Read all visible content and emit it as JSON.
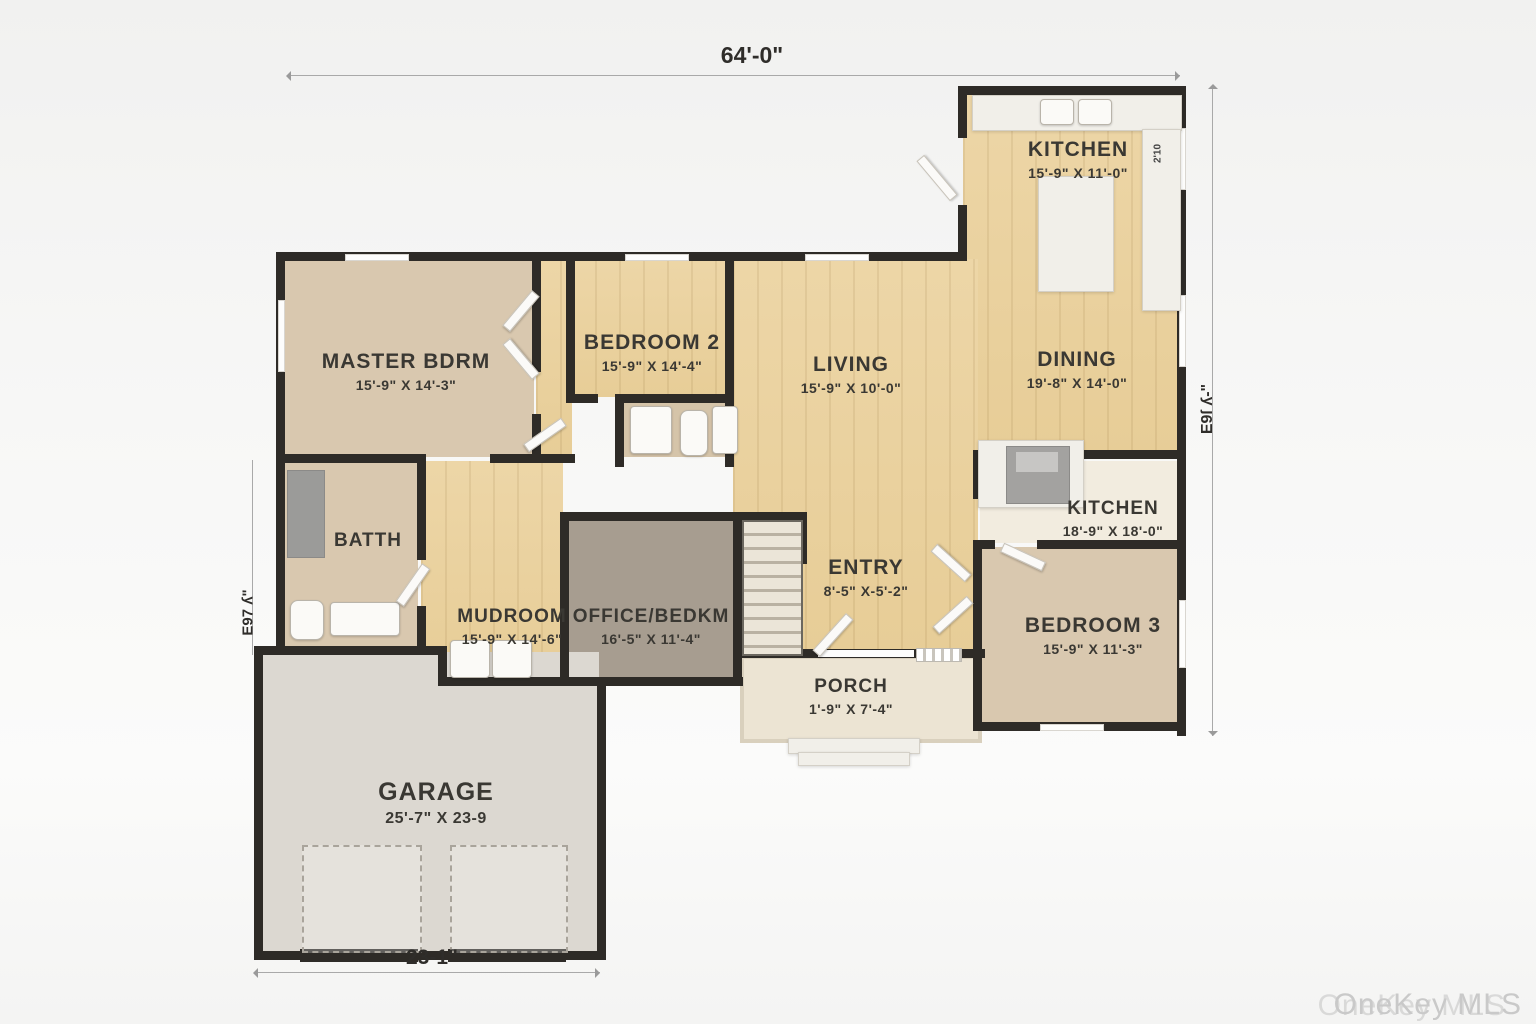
{
  "watermark": "OneKey MLS",
  "plan": {
    "dimensions": {
      "top": "64'-0\"",
      "bottom": "23-1\"",
      "right_vertical": "E9ſ ʎ-\"",
      "left_vertical": "E97 ʎ\"",
      "kitchen_counter": "2'10"
    },
    "rooms": {
      "kitchen": {
        "name": "KITCHEN",
        "dims": "15'-9\" X 11'-0\""
      },
      "master": {
        "name": "MASTER BDRM",
        "dims": "15'-9\" X 14'-3\""
      },
      "bedroom2": {
        "name": "BEDROOM 2",
        "dims": "15'-9\" X 14'-4\""
      },
      "living": {
        "name": "LIVING",
        "dims": "15'-9\" X 10'-0\""
      },
      "dining": {
        "name": "DINING",
        "dims": "19'-8\" X 14'-0\""
      },
      "kitchen2": {
        "name": "KITCHEN",
        "dims": "18'-9\" X 18'-0\""
      },
      "bath": {
        "name": "BATTH",
        "dims": ""
      },
      "mudroom": {
        "name": "MUDROOM",
        "dims": "15'-9\" X 14'-6\""
      },
      "office": {
        "name": "OFFICE/BEDKM",
        "dims": "16'-5\" X 11'-4\""
      },
      "entry": {
        "name": "ENTRY",
        "dims": "8'-5\" X-5'-2\""
      },
      "bedroom3": {
        "name": "BEDROOM 3",
        "dims": "15'-9\" X 11'-3\""
      },
      "porch": {
        "name": "PORCH",
        "dims": "1'-9\" X 7'-4\""
      },
      "garage": {
        "name": "GARAGE",
        "dims": "25'-7\" X 23-9"
      }
    }
  }
}
